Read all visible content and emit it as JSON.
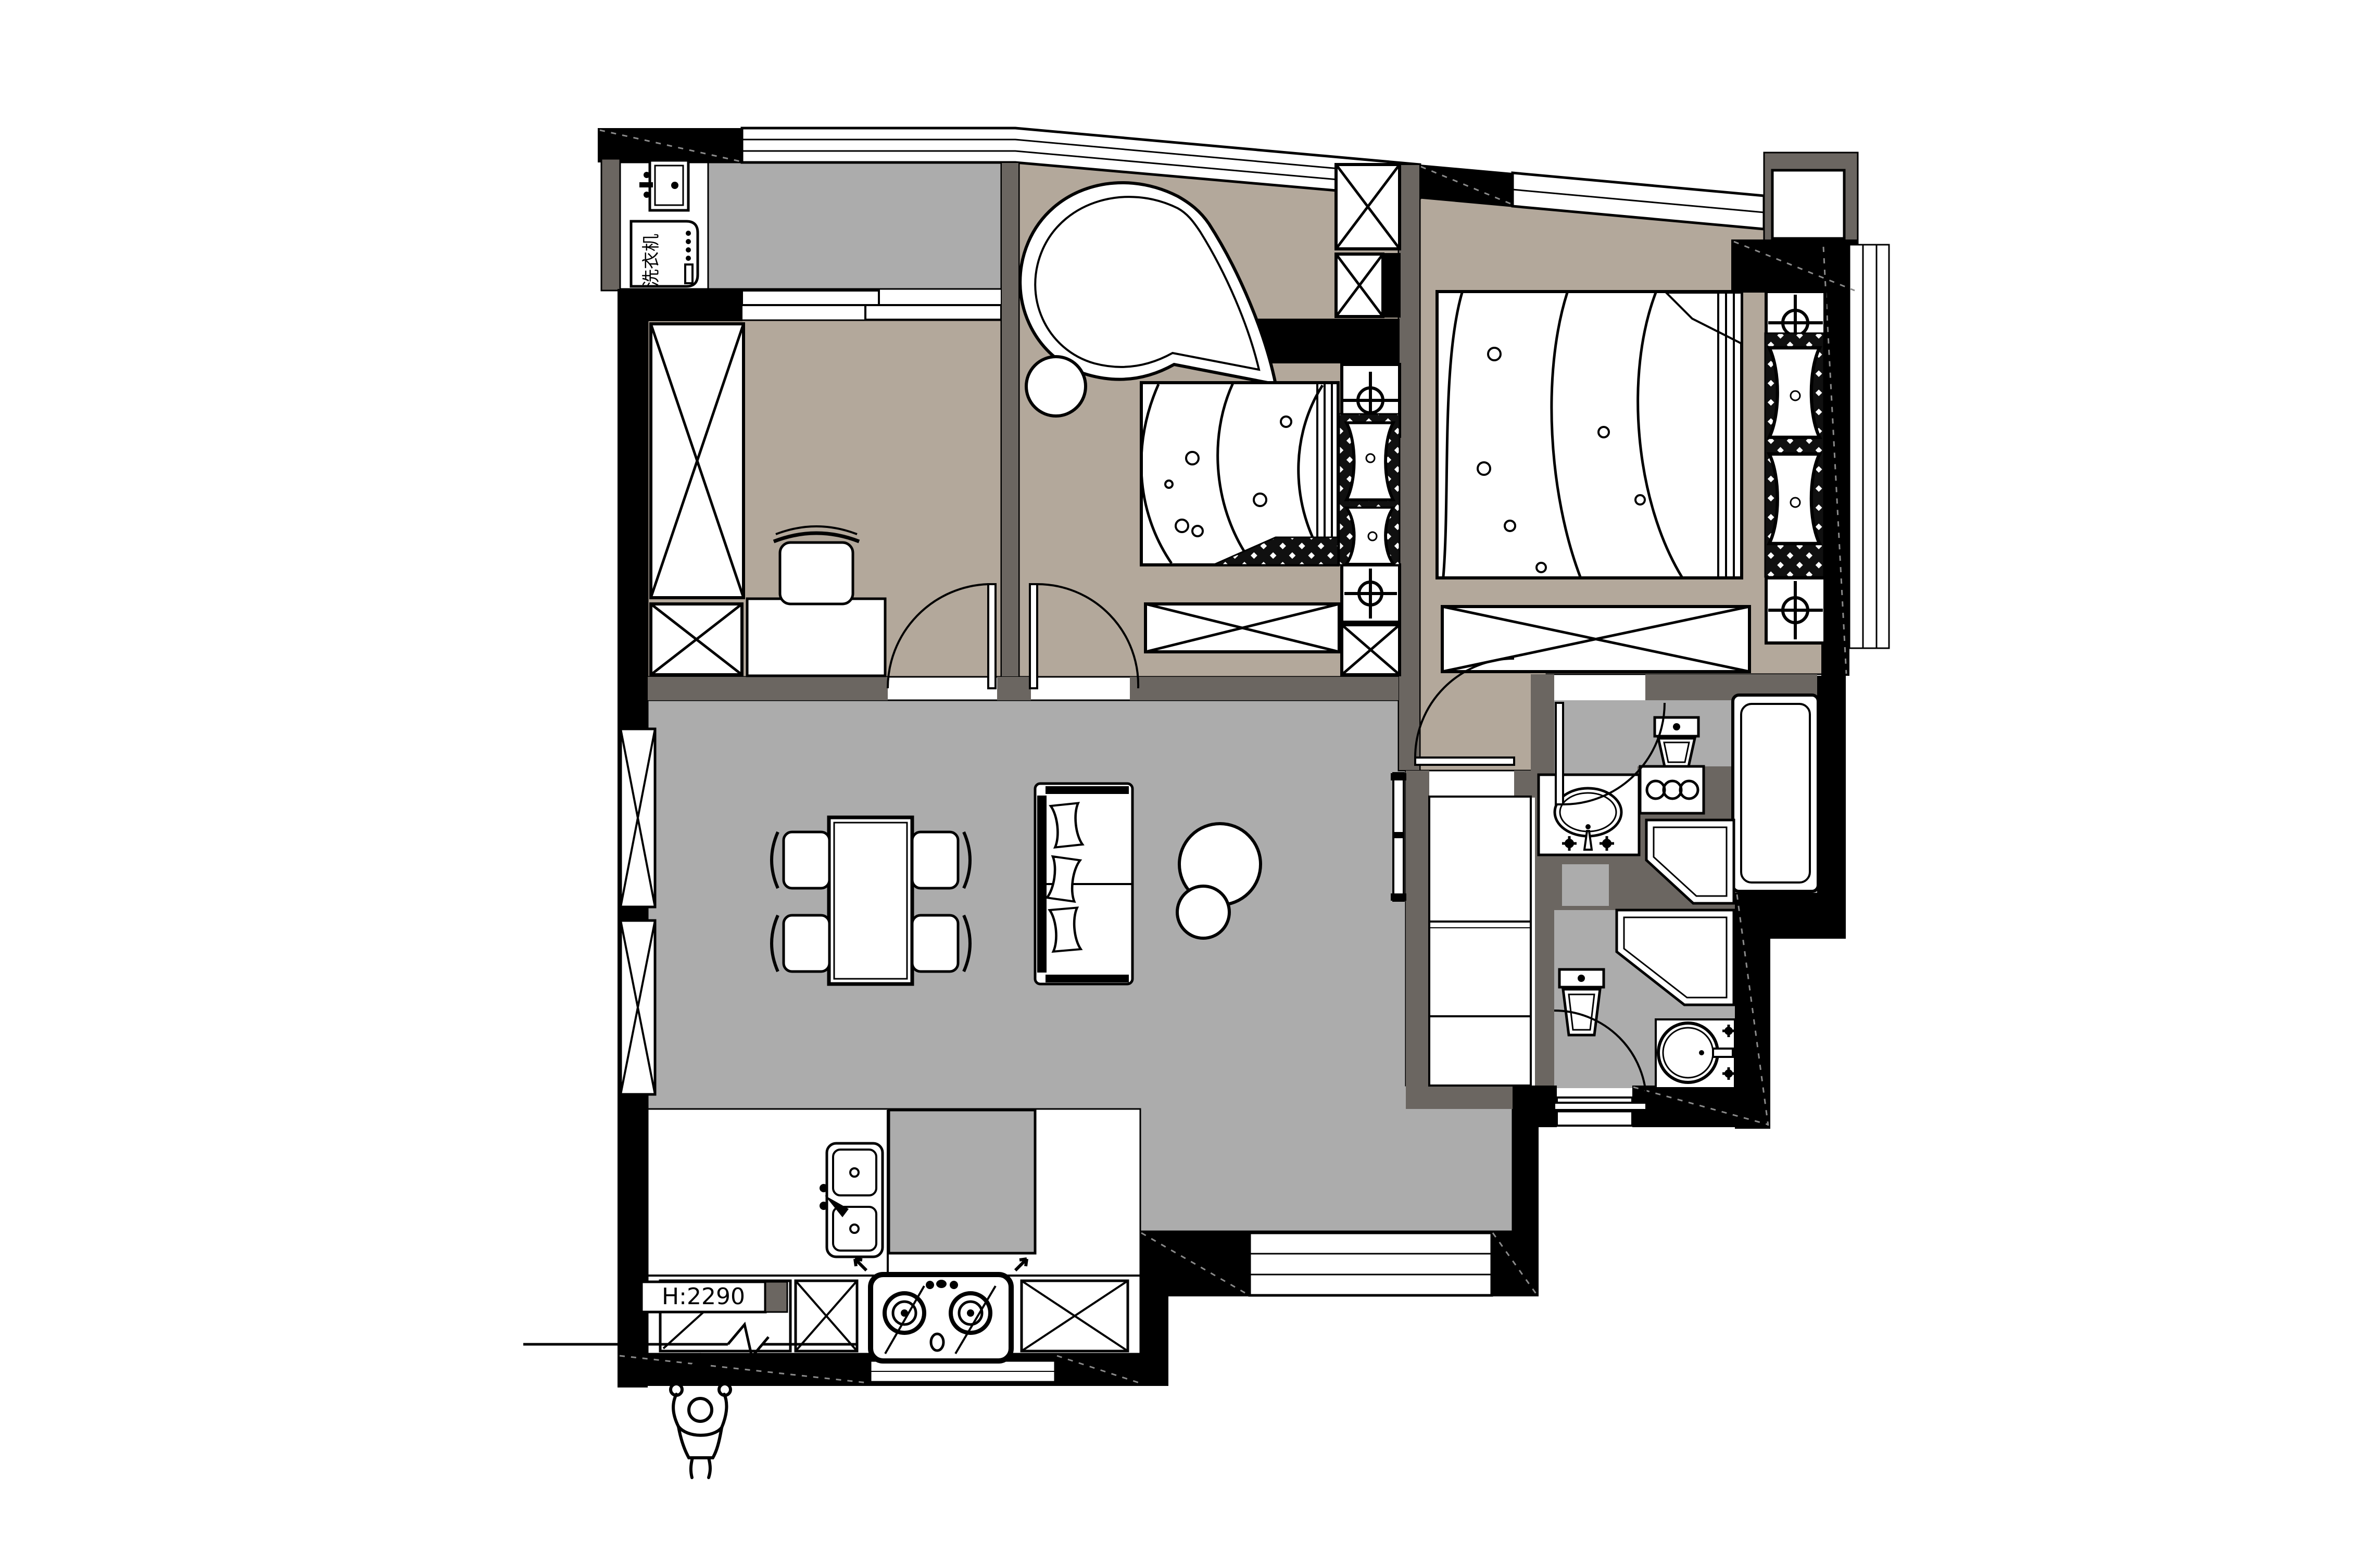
{
  "annotations": {
    "washing_machine": "洗衣机",
    "ceiling_height": "H:2290"
  },
  "colors": {
    "wall_black": "#000000",
    "wall_partition": "#6b6661",
    "floor_living_gray": "#acacac",
    "floor_bedroom_taupe": "#b3a89b",
    "fixture_white": "#ffffff",
    "background": "#ffffff"
  }
}
